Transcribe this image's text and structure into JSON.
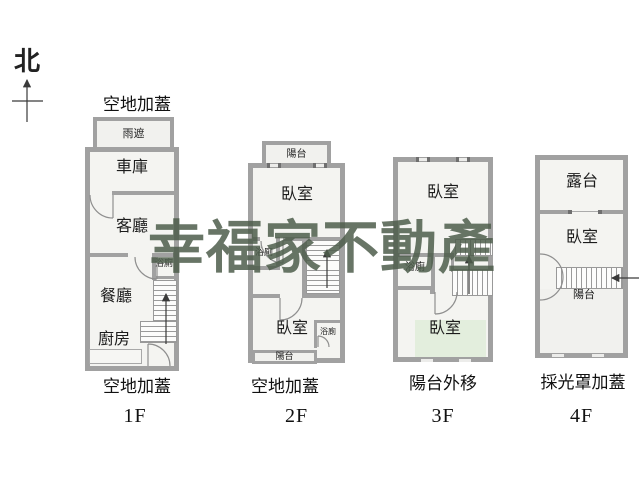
{
  "watermark": {
    "text": "幸福家不動產",
    "color": "#4e5e4c"
  },
  "compass": {
    "north_label": "北"
  },
  "palette": {
    "wall": "#a1a1a1",
    "interior": "#f4f4f1",
    "annex_interior": "#f1f1ee",
    "green_room": "#e3eedd",
    "text": "#1c1c1c"
  },
  "floors": [
    {
      "label": "1F",
      "top_caption": "空地加蓋",
      "bottom_caption": "空地加蓋",
      "rooms": {
        "canopy": "雨遮",
        "garage": "車庫",
        "living_room": "客廳",
        "bathroom": "浴廁",
        "dining_room": "餐廳",
        "kitchen": "廚房"
      }
    },
    {
      "label": "2F",
      "bottom_caption": "空地加蓋",
      "rooms": {
        "balcony_top": "陽台",
        "bedroom_top": "臥室",
        "bathroom_left": "浴廁",
        "bedroom_bottom": "臥室",
        "bathroom_right": "浴廁",
        "balcony_bottom": "陽台"
      }
    },
    {
      "label": "3F",
      "bottom_caption": "陽台外移",
      "rooms": {
        "bedroom_top": "臥室",
        "bathroom": "浴廁",
        "bedroom_bottom": "臥室"
      }
    },
    {
      "label": "4F",
      "bottom_caption": "採光罩加蓋",
      "rooms": {
        "roof_terrace": "露台",
        "bedroom": "臥室",
        "balcony": "陽台"
      }
    }
  ]
}
